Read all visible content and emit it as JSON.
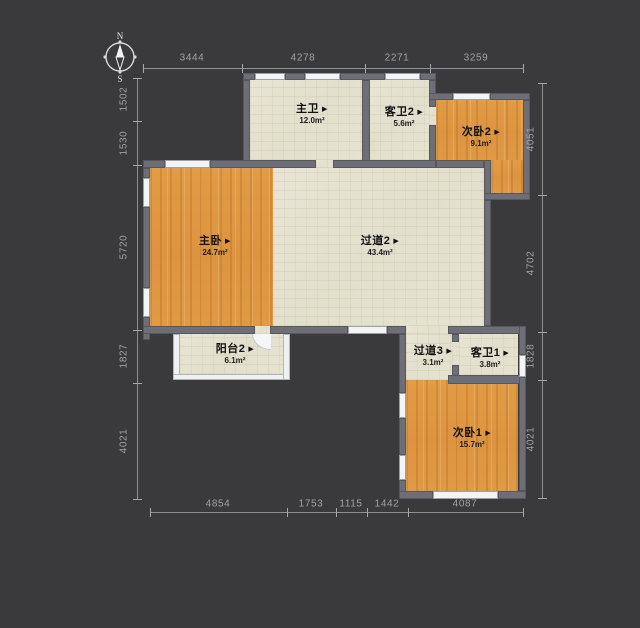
{
  "compass": {
    "north": "N",
    "south": "S"
  },
  "ui": {
    "room_arrow": "▶"
  },
  "rooms": [
    {
      "name": "主卫",
      "area": "12.0m²"
    },
    {
      "name": "客卫2",
      "area": "5.6m²"
    },
    {
      "name": "次卧2",
      "area": "9.1m²"
    },
    {
      "name": "主卧",
      "area": "24.7m²"
    },
    {
      "name": "过道2",
      "area": "43.4m²"
    },
    {
      "name": "阳台2",
      "area": "6.1m²"
    },
    {
      "name": "过道3",
      "area": "3.1m²"
    },
    {
      "name": "客卫1",
      "area": "3.8m²"
    },
    {
      "name": "次卧1",
      "area": "15.7m²"
    }
  ],
  "dimensions": {
    "top": [
      "3444",
      "4278",
      "2271",
      "3259"
    ],
    "left": [
      "1502",
      "1530",
      "5720",
      "1827",
      "4021"
    ],
    "right": [
      "4051",
      "4702",
      "1828",
      "4021"
    ],
    "bottom": [
      "4854",
      "1753",
      "1115",
      "1442",
      "4087"
    ]
  },
  "colors": {
    "background": "#3a393b",
    "wall": "#6e6e76",
    "floor_light": "#e6e3d1",
    "floor_wood": "#df9a42",
    "window": "#f3f4f6",
    "dim_text": "#a2a2a2",
    "label_text": "#101010"
  }
}
